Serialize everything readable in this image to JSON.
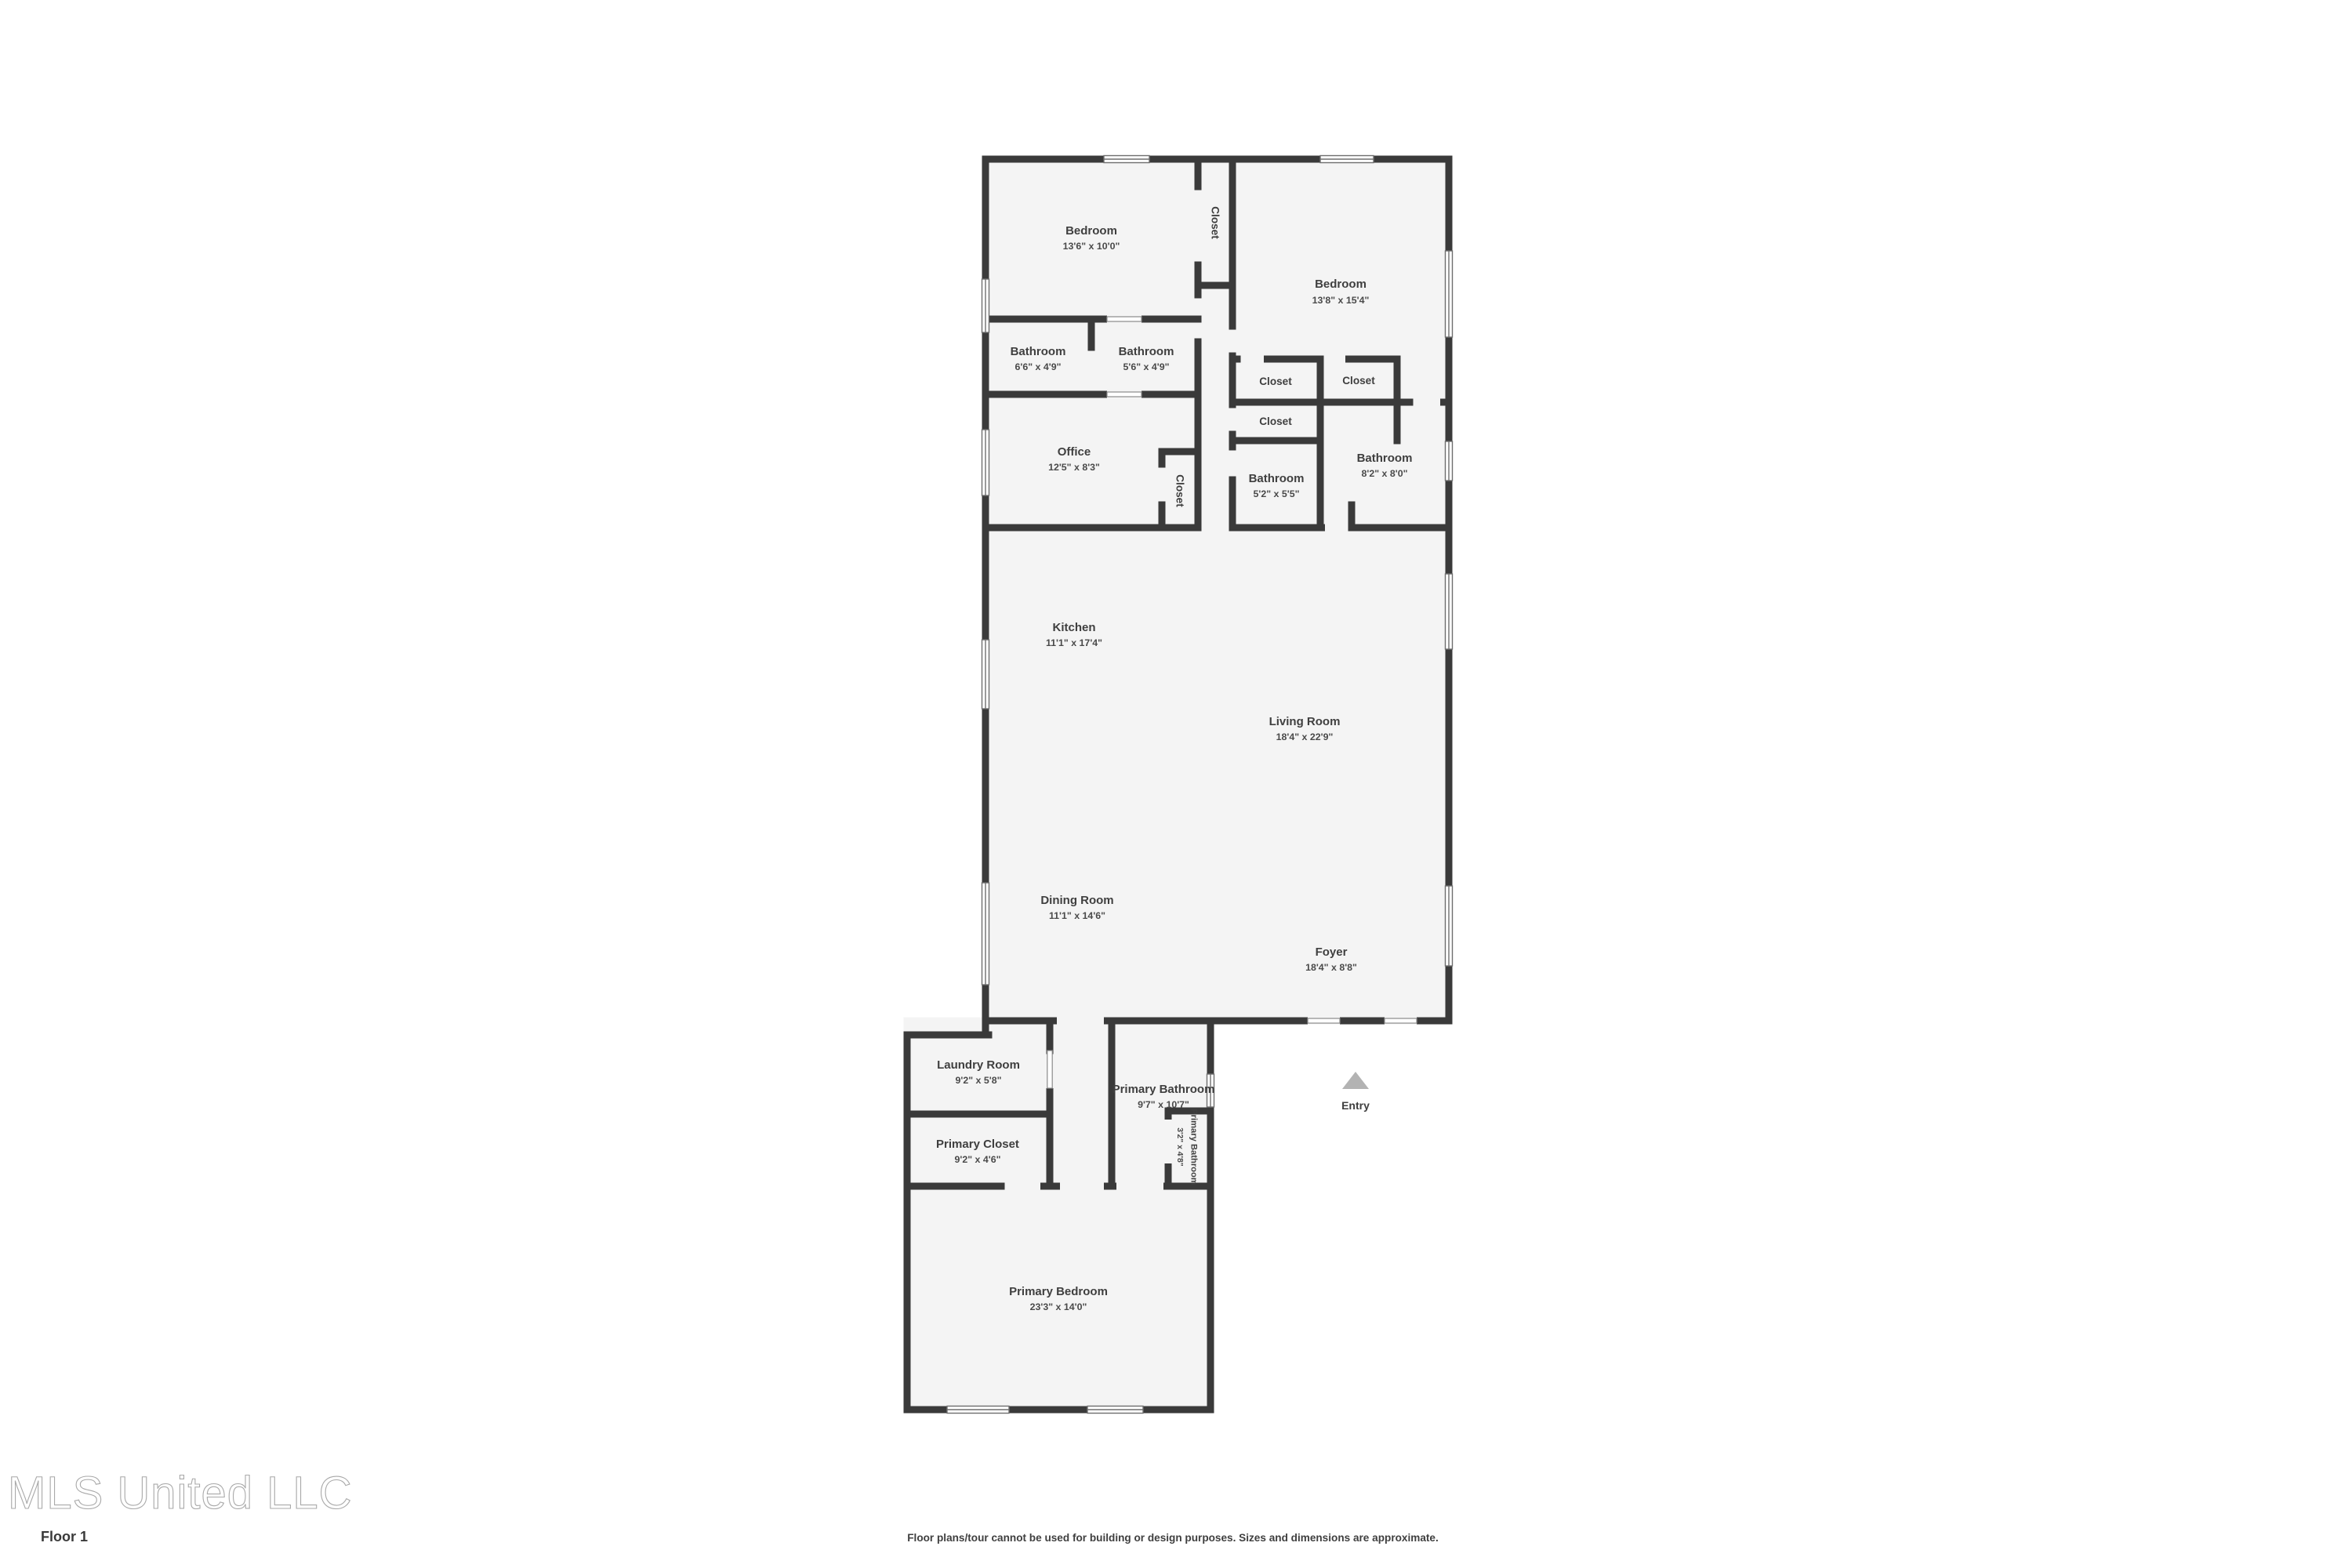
{
  "floor_plan": {
    "rooms": [
      {
        "id": "bedroom-1",
        "name": "Bedroom",
        "dims": "13'6\" x 10'0\""
      },
      {
        "id": "closet-bedroom-1",
        "name": "Closet",
        "dims": ""
      },
      {
        "id": "bedroom-2",
        "name": "Bedroom",
        "dims": "13'8\" x 15'4\""
      },
      {
        "id": "bathroom-1",
        "name": "Bathroom",
        "dims": "6'6\" x 4'9\""
      },
      {
        "id": "bathroom-2",
        "name": "Bathroom",
        "dims": "5'6\" x 4'9\""
      },
      {
        "id": "office",
        "name": "Office",
        "dims": "12'5\" x 8'3\""
      },
      {
        "id": "office-closet",
        "name": "Closet",
        "dims": ""
      },
      {
        "id": "closet-a",
        "name": "Closet",
        "dims": ""
      },
      {
        "id": "closet-b",
        "name": "Closet",
        "dims": ""
      },
      {
        "id": "closet-c",
        "name": "Closet",
        "dims": ""
      },
      {
        "id": "bathroom-3",
        "name": "Bathroom",
        "dims": "5'2\" x 5'5\""
      },
      {
        "id": "bathroom-4",
        "name": "Bathroom",
        "dims": "8'2\" x 8'0\""
      },
      {
        "id": "kitchen",
        "name": "Kitchen",
        "dims": "11'1\" x 17'4\""
      },
      {
        "id": "living-room",
        "name": "Living Room",
        "dims": "18'4\" x 22'9\""
      },
      {
        "id": "dining-room",
        "name": "Dining Room",
        "dims": "11'1\" x 14'6\""
      },
      {
        "id": "foyer",
        "name": "Foyer",
        "dims": "18'4\" x 8'8\""
      },
      {
        "id": "laundry-room",
        "name": "Laundry Room",
        "dims": "9'2\" x 5'8\""
      },
      {
        "id": "primary-closet",
        "name": "Primary Closet",
        "dims": "9'2\" x 4'6\""
      },
      {
        "id": "primary-bathroom",
        "name": "Primary Bathroom",
        "dims": "9'7\" x 10'7\""
      },
      {
        "id": "primary-bathroom-2",
        "name": "Primary Bathroom",
        "dims": "3'2\" x 4'8\""
      },
      {
        "id": "primary-bedroom",
        "name": "Primary Bedroom",
        "dims": "23'3\" x 14'0\""
      }
    ],
    "entry": {
      "label": "Entry"
    },
    "footer": {
      "brand": "MLS United LLC",
      "floor_label": "Floor 1",
      "disclaimer": "Floor plans/tour cannot be used for building or design purposes. Sizes and dimensions are approximate."
    },
    "colors": {
      "wall": "#3a3a3a",
      "room_fill": "#f4f4f4",
      "label": "#3f3f3f",
      "arrow": "#b3b3b3",
      "window_frame": "#6e6e6e"
    }
  }
}
